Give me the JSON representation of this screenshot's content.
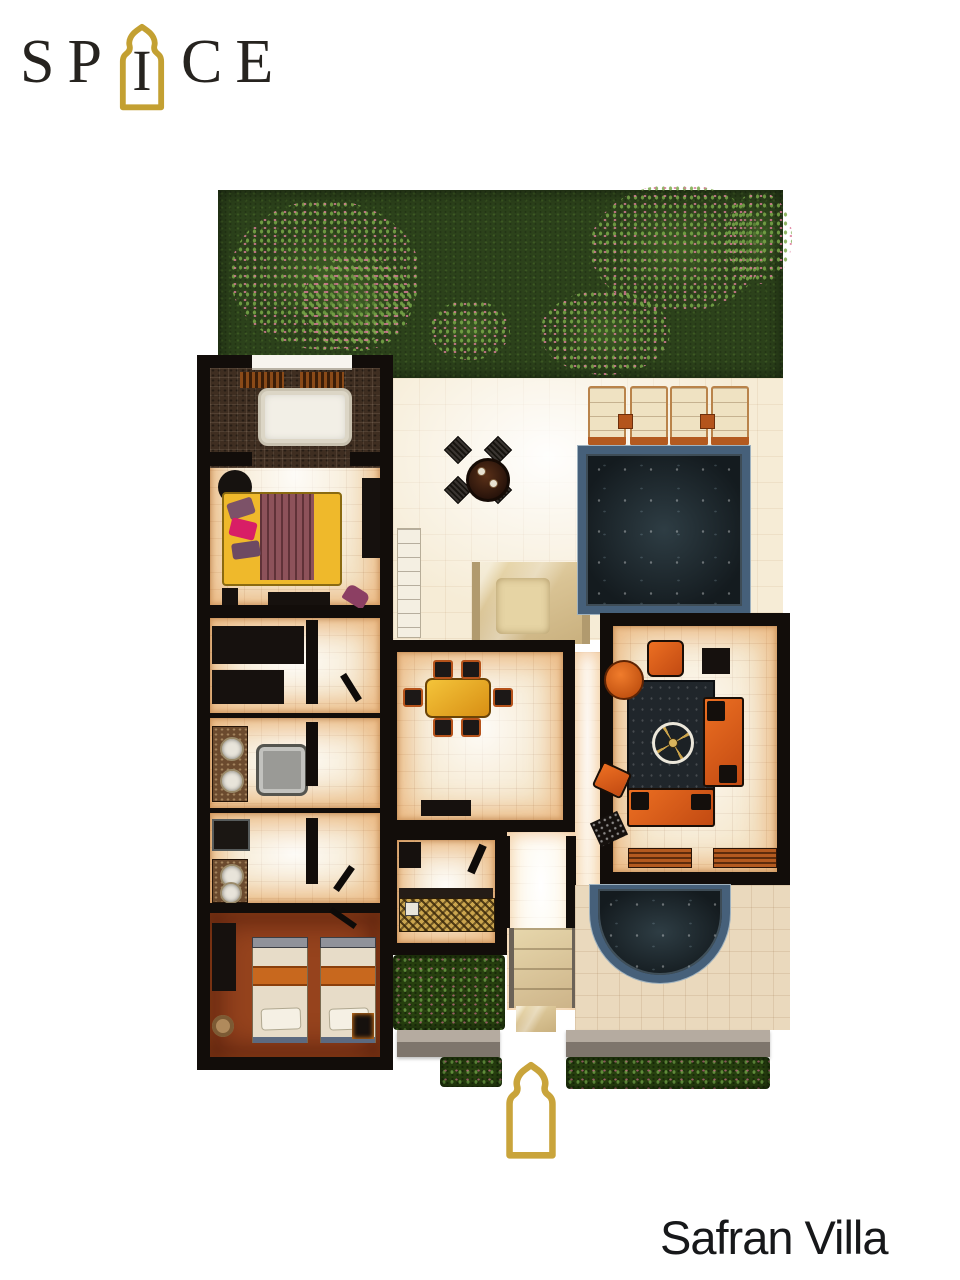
{
  "brand": {
    "name_part1": "SP",
    "arch_letter": "I",
    "name_part2": "CE"
  },
  "title": "Safran Villa",
  "icons": {
    "logo_arch": "moorish-arch",
    "entrance_marker": "moorish-arch"
  },
  "colors": {
    "wall": "#120d0a",
    "gold": "#c3a032",
    "grass": "#2c421b",
    "cream": "#f5e7cc",
    "deck": "#f6ecd6",
    "stone": "#3f2e21",
    "terra": "#96431d",
    "water": "#1d272c",
    "tile": "#46607a",
    "orange": "#d8601e",
    "amber": "#e8a81e",
    "bedyellow": "#efb92b",
    "maroon": "#8d525a",
    "marble": "#dcc89c",
    "gray": "#948a81",
    "titlecolor": "#17181a"
  }
}
